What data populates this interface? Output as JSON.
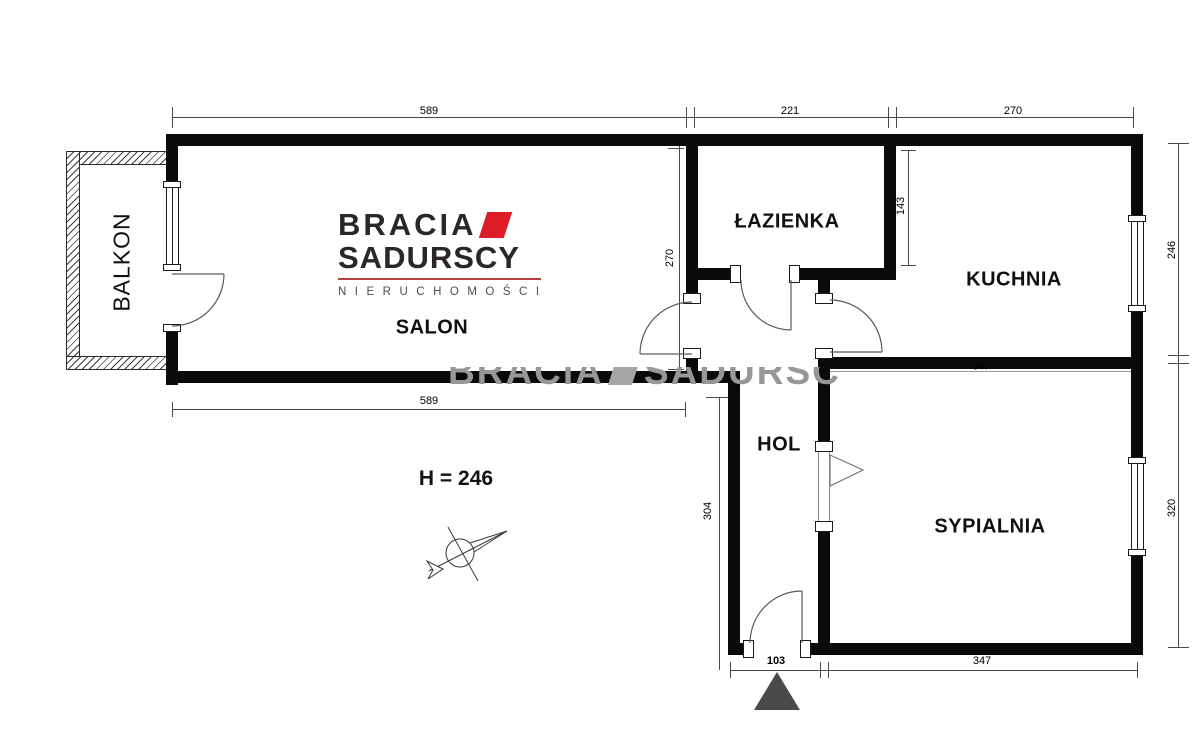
{
  "brand": {
    "line1": "BRACIA",
    "line2": "SADURSCY",
    "line3": "NIERUCHOMOŚCI"
  },
  "watermark": {
    "part1": "BRACIA",
    "part2": "SADURSC"
  },
  "rooms": {
    "balkon": "BALKON",
    "salon": "SALON",
    "lazienka": "ŁAZIENKA",
    "kuchnia": "KUCHNIA",
    "hol": "HOL",
    "sypialnia": "SYPIALNIA"
  },
  "dimensions": {
    "salon_width_top": "589",
    "lazienka_width": "221",
    "kuchnia_width": "270",
    "salon_depth": "270",
    "kuchnia_nook_depth": "143",
    "kuchnia_height_right": "246",
    "sypialnia_height_right": "320",
    "kuchnia_sypialnia_wall": "347",
    "salon_width_bottom": "589",
    "hol_depth": "304",
    "entrance_width": "103",
    "sypialnia_width_bottom": "347",
    "ceiling_height": "H = 246"
  }
}
